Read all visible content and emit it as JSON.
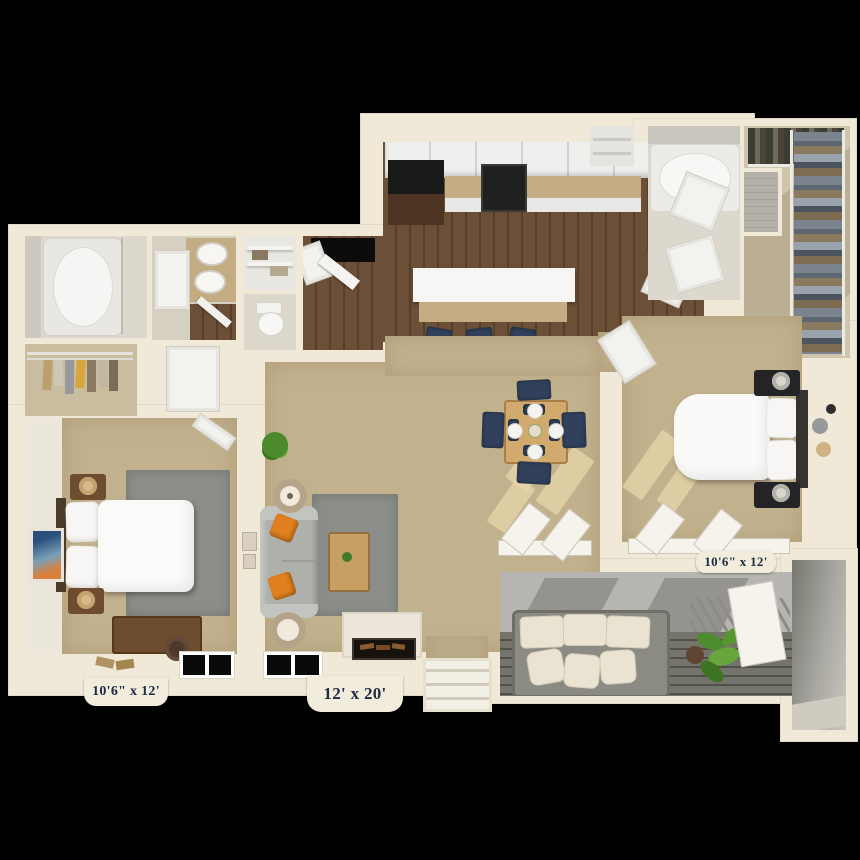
{
  "floor_plan": {
    "kind": "3d-apartment-floor-plan",
    "background": "#000000",
    "labels": {
      "bedroom_left": "10'6\" x 12'",
      "living_room": "12' x 20'",
      "bedroom_right": "10'6\" x 12'"
    },
    "rooms": [
      "kitchen",
      "dining-area",
      "living-room",
      "bedroom-left",
      "bedroom-right",
      "bathroom-left",
      "bathroom-right",
      "walk-in-closet-left",
      "walk-in-closet-right",
      "linen-closet",
      "toilet-room",
      "pantry",
      "entry",
      "patio",
      "storage",
      "stairs"
    ],
    "colors": {
      "wall": "#f0e9d8",
      "carpet": "#c2b18d",
      "wood_floor": "#64492f",
      "area_rug": "#8b8d88",
      "sofa_gray": "#aeb0ac",
      "accent_pillow_orange": "#e0801f",
      "navy_seating": "#31415c",
      "patio_deck": "#6e6d66",
      "fixture_white": "#f7f6f4",
      "label_text": "#1d2a40"
    }
  }
}
